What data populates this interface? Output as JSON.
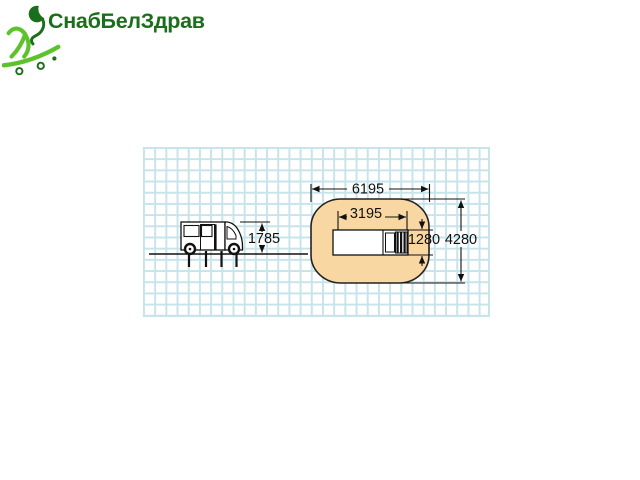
{
  "logo": {
    "brand_name": "СнабБелЗдрав",
    "icon": "skateboarder-icon",
    "colors": {
      "brand_green_dark": "#1b6e1b",
      "brand_green_bright": "#5cc32c"
    }
  },
  "diagram": {
    "colors": {
      "grid_line": "#c7e4ea",
      "safety_zone_fill": "#f9d7a2",
      "outline": "#1a1a1a"
    },
    "side_view": {
      "height_label": "1785"
    },
    "top_view": {
      "zone_length_label": "6195",
      "equipment_length_label": "3195",
      "equipment_width_label": "1280",
      "zone_width_label": "4280"
    }
  }
}
